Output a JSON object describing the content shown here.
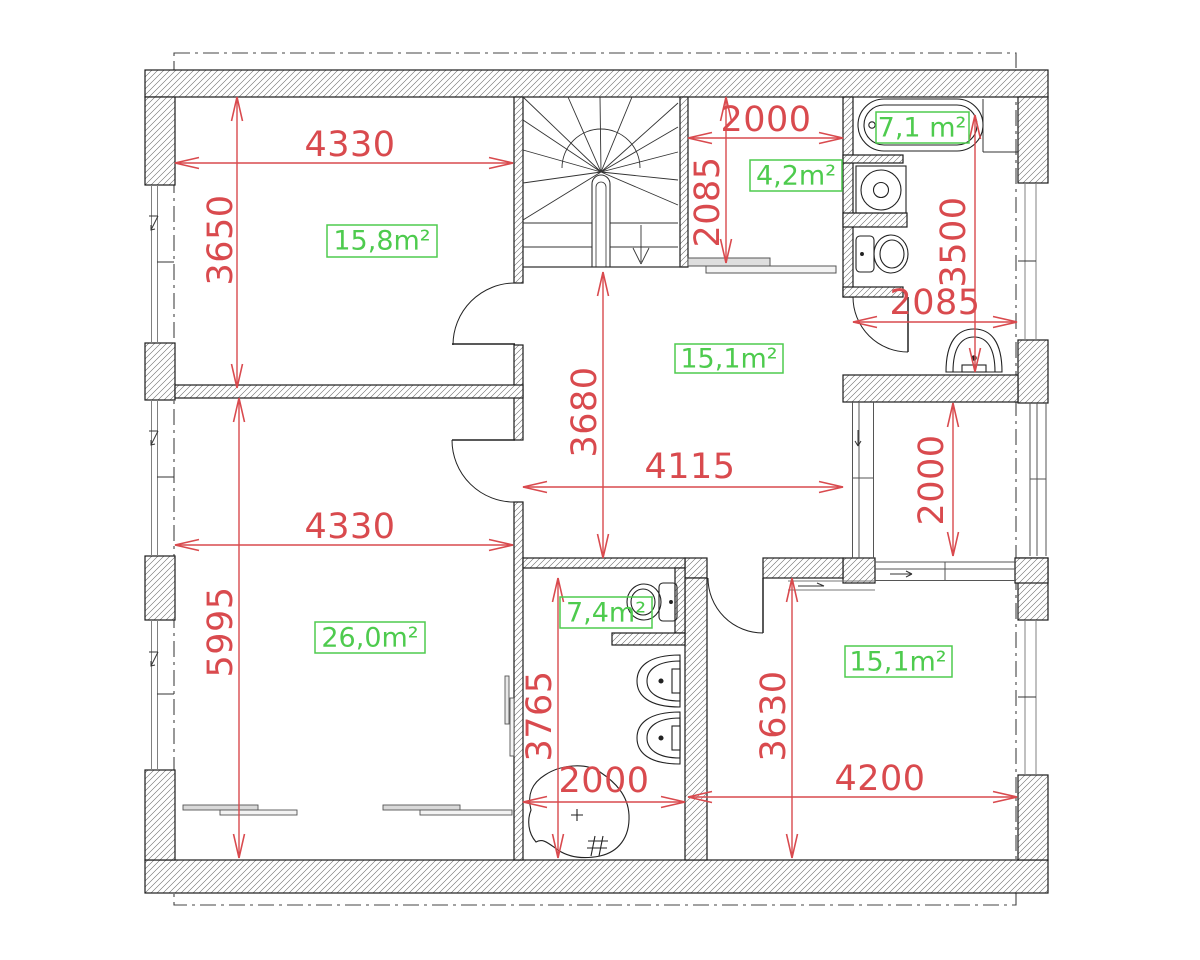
{
  "drawing": {
    "kind": "floor-plan",
    "units": "mm"
  },
  "colors": {
    "dimension_red": "#d94a4e",
    "area_green": "#4ecb4e",
    "wall_line": "#1c1c1c"
  },
  "rooms": {
    "bedroom_top_left": {
      "area": "15,8m²",
      "width": "4330",
      "height": "3650"
    },
    "closet": {
      "area": "4,2m²",
      "width": "2000",
      "height": "2085"
    },
    "bathroom_top": {
      "area": "7,1 m²",
      "width": "2085",
      "height": "3500"
    },
    "hall": {
      "area": "15,1m²",
      "width": "4115",
      "height": "3680"
    },
    "living_bottom_left": {
      "area": "26,0m²",
      "width": "4330",
      "height": "5995"
    },
    "balcony": {
      "height": "2000"
    },
    "bathroom_bottom": {
      "area": "7,4m²",
      "width": "2000",
      "height": "3765"
    },
    "bedroom_bottom_right": {
      "area": "15,1m²",
      "width": "4200",
      "height": "3630"
    }
  },
  "fixtures": [
    "staircase-winder",
    "bathtub",
    "washing-machine",
    "toilet",
    "wall-sink",
    "toilet",
    "double-sink",
    "corner-bathtub",
    "sliding-door",
    "wardrobe"
  ]
}
